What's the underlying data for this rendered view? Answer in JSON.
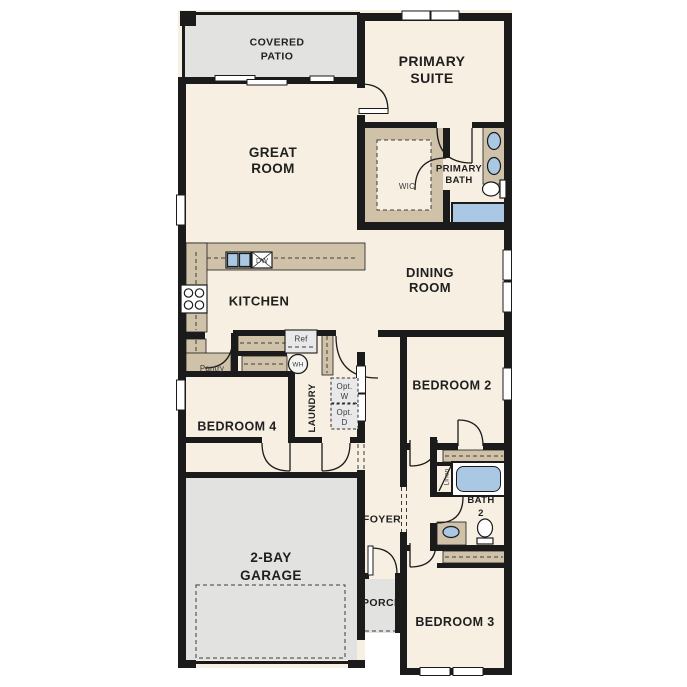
{
  "rooms": {
    "covered_patio": {
      "line1": "COVERED",
      "line2": "PATIO"
    },
    "primary_suite": {
      "line1": "PRIMARY",
      "line2": "SUITE"
    },
    "great_room": {
      "line1": "GREAT",
      "line2": "ROOM"
    },
    "wic": {
      "label": "WIC"
    },
    "primary_bath": {
      "line1": "PRIMARY",
      "line2": "BATH"
    },
    "dining_room": {
      "line1": "DINING",
      "line2": "ROOM"
    },
    "kitchen": {
      "label": "KITCHEN"
    },
    "pantry": {
      "label": "Pantry"
    },
    "laundry": {
      "label": "LAUNDRY"
    },
    "bedroom2": {
      "label": "BEDROOM 2"
    },
    "bedroom3": {
      "label": "BEDROOM 3"
    },
    "bedroom4": {
      "label": "BEDROOM 4"
    },
    "bath2": {
      "line1": "BATH",
      "line2": "2"
    },
    "linen": {
      "label": "Linen"
    },
    "foyer": {
      "label": "FOYER"
    },
    "porch": {
      "label": "PORCH"
    },
    "garage": {
      "line1": "2-BAY",
      "line2": "GARAGE"
    }
  },
  "appliances": {
    "dishwasher": "DW",
    "refrigerator": "Ref",
    "water_heater": "WH",
    "opt_washer_line1": "Opt.",
    "opt_washer_line2": "W",
    "opt_dryer_line1": "Opt.",
    "opt_dryer_line2": "D"
  },
  "colors": {
    "floor_cream": "#f7efe2",
    "outdoor_gray": "#e2e2e0",
    "cabinet_tan": "#cfc2a9",
    "fixture_blue": "#aac8e4",
    "wall_black": "#1b1b1b",
    "appliance_gray": "#e9e9e9",
    "label_dark": "#1f1f1f"
  }
}
